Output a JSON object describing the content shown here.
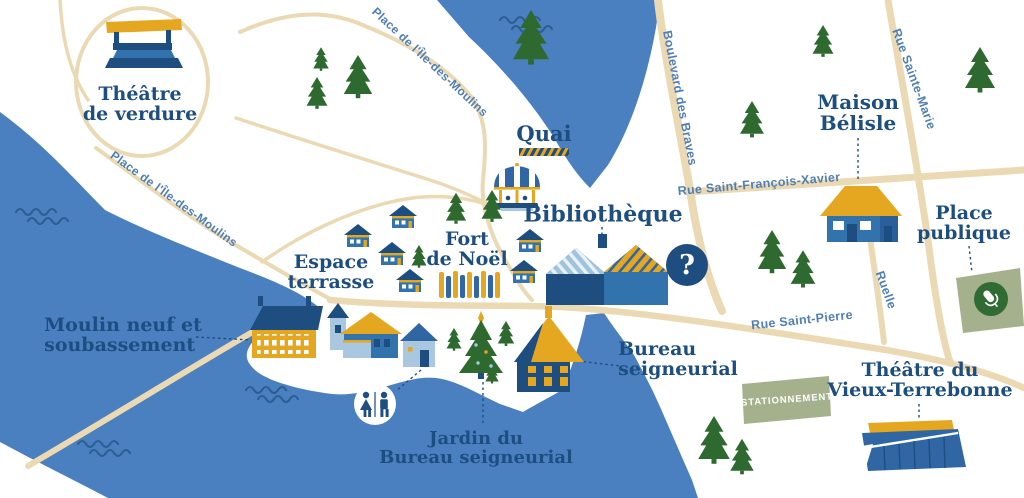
{
  "colors": {
    "water": "#4A80C0",
    "wave": "#2B5E93",
    "navy": "#1E4D7F",
    "mid_blue": "#3273AE",
    "roof_blue": "#2F66A3",
    "light_blue": "#A9C7DF",
    "pale_blue": "#9FC3DB",
    "gold": "#E5A71F",
    "pine_green": "#2E6A30",
    "sage_green": "#A5B18C",
    "circle_green": "#2F6B33",
    "road_beige": "#EBD9B3",
    "place_text": "#1D4E80",
    "street_text": "#4F7FB6"
  },
  "places": {
    "theatre_verdure": {
      "line1": "Théâtre",
      "line2": "de verdure"
    },
    "quai": {
      "line1": "Quai"
    },
    "bibliotheque": {
      "line1": "Bibliothèque"
    },
    "fort_noel": {
      "line1": "Fort",
      "line2": "de Noël"
    },
    "espace_terrasse": {
      "line1": "Espace",
      "line2": "terrasse"
    },
    "moulin_neuf": {
      "line1": "Moulin neuf et",
      "line2": "soubassement"
    },
    "bureau_seigneurial": {
      "line1": "Bureau",
      "line2": "seigneurial"
    },
    "jardin_bureau": {
      "line1": "Jardin du",
      "line2": "Bureau seigneurial"
    },
    "maison_belisle": {
      "line1": "Maison",
      "line2": "Bélisle"
    },
    "place_publique": {
      "line1": "Place",
      "line2": "publique"
    },
    "theatre_vieux_terrebonne": {
      "line1": "Théâtre du",
      "line2": "Vieux-Terrebonne"
    }
  },
  "streets": {
    "place_ile_moulins_top": "Place de l'Île-des-Moulins",
    "place_ile_moulins_left": "Place de l'Île-des-Moulins",
    "boulevard_braves": "Boulevard des Braves",
    "rue_st_francois_xavier": "Rue Saint-François-Xavier",
    "rue_sainte_marie": "Rue Sainte-Marie",
    "ruelle": "Ruelle",
    "rue_saint_pierre": "Rue Saint-Pierre"
  },
  "markers": {
    "parking_label": "STATIONNEMENT",
    "info_symbol": "?"
  },
  "icons": {
    "amphitheater": "outdoor-stage",
    "carousel": "merry-go-round",
    "quai_stripes": "dock-hazard-stripes",
    "library": "two-gabled-building",
    "stall": "christmas-market-stall",
    "pine": "pine-tree",
    "christmas_tree": "decorated-tree-with-star",
    "mill": "long-mill-building",
    "restroom": "man-woman-pictogram",
    "info": "question-mark-circle",
    "microphone": "microphone-in-green-circle",
    "parking": "green-parking-area",
    "waves": "water-squiggles"
  }
}
